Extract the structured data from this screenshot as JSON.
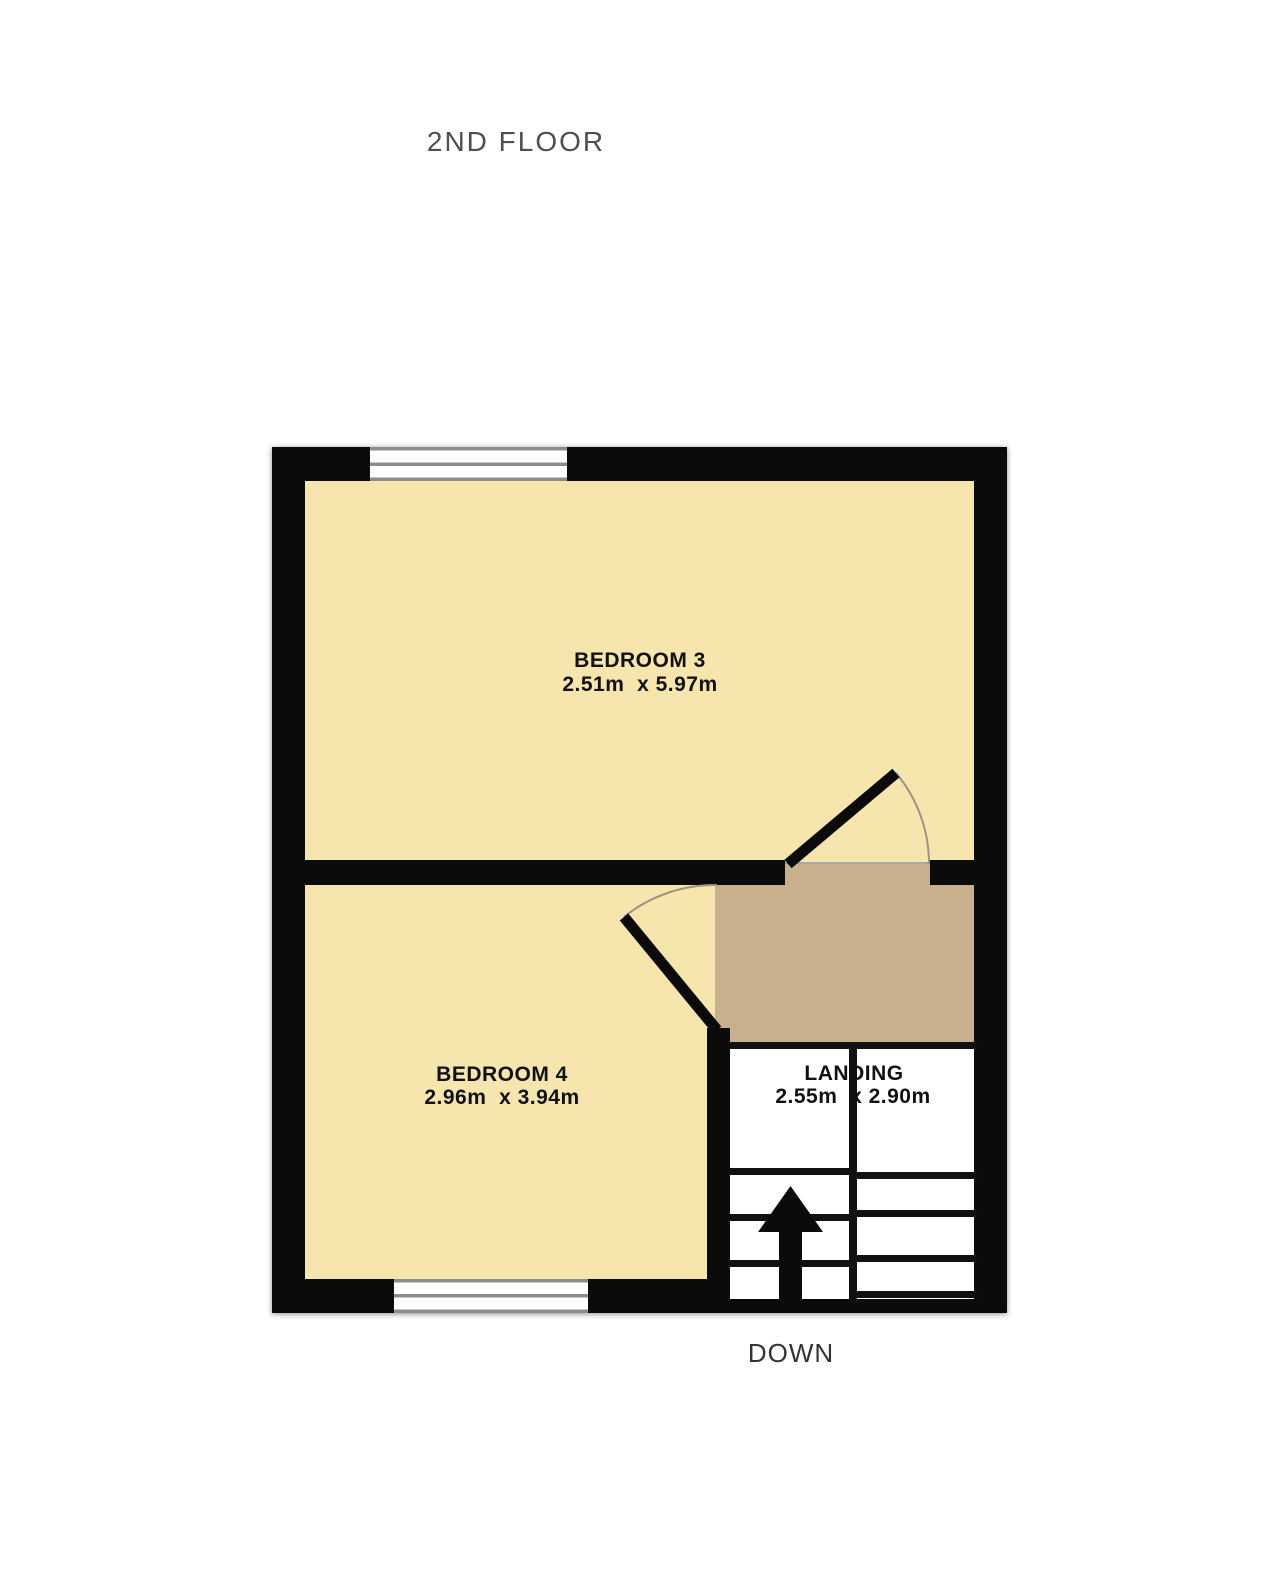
{
  "page": {
    "title": "2ND FLOOR"
  },
  "plan": {
    "colors": {
      "room_fill": "#f6e5ac",
      "hallway_fill": "#c8b08c",
      "wall": "#0b0b0b",
      "stair_well": "#ffffff",
      "window_frame": "#8c8c8c",
      "door_arc": "#9a9488",
      "title_text": "#4f4f4f",
      "label_text": "#111111"
    },
    "rooms": [
      {
        "name": "BEDROOM 3",
        "dimensions": "2.51m  x 5.97m"
      },
      {
        "name": "BEDROOM 4",
        "dimensions": "2.96m  x 3.94m"
      },
      {
        "name": "LANDING",
        "dimensions": "2.55m  x 2.90m"
      }
    ],
    "stairs": {
      "direction_label": "DOWN"
    }
  }
}
